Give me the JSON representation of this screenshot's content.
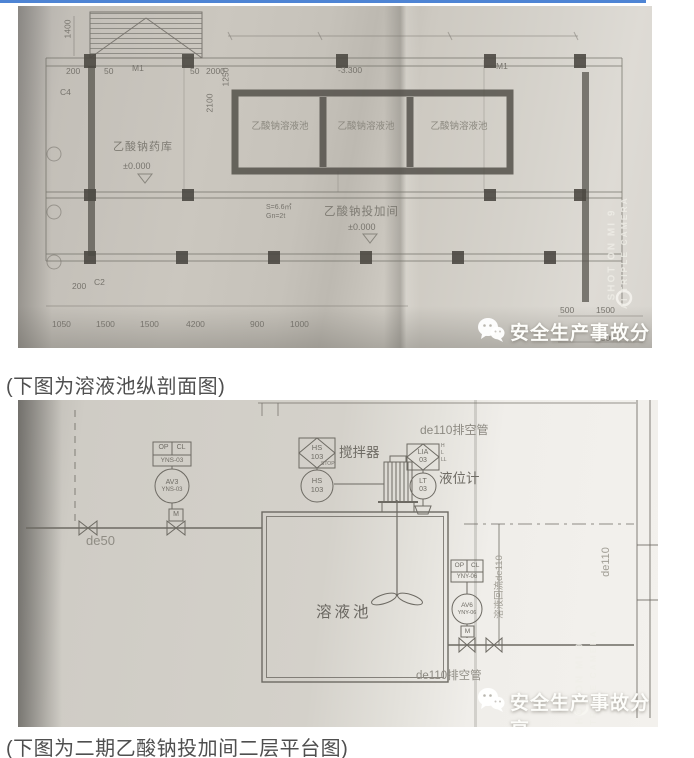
{
  "page": {
    "accent_blue": "#4e84d4",
    "caption1": "(下图为溶液池纵剖面图)",
    "caption2": "(下图为二期乙酸钠投加间二层平台图)"
  },
  "watermark": {
    "text": "安全生产事故分享",
    "camera1": "SHOT ON MI 9",
    "camera2": "AI TRIPLE CAMERA"
  },
  "plan": {
    "tanks": [
      "乙酸钠溶液池",
      "乙酸钠溶液池",
      "乙酸钠溶液池"
    ],
    "storage_room": "乙酸钠药库",
    "dosing_room": "乙酸钠投加间",
    "elev_zero": "±0.000",
    "elev_neg": "-3.300",
    "area": "S=6.6㎡",
    "load": "Gn=2t",
    "door": "M1",
    "win_c2": "C2",
    "win_c4": "C4",
    "dim_200": "200",
    "dim_50": "50",
    "dim_2000": "2000",
    "dim_1400": "1400",
    "dim_2100": "2100",
    "dim_1250": "1250",
    "dims_bottom": [
      "1050",
      "1500",
      "1500",
      "4200",
      "900",
      "1000"
    ],
    "dim_500": "500",
    "dim_1500r": "1500",
    "dim_4500": "4500"
  },
  "pid": {
    "vent_top": "de110排空管",
    "vent_bottom": "de110排空管",
    "de50": "de50",
    "de110": "de110",
    "return_line": "溶液回流de110",
    "agitator": "搅拌器",
    "level_gauge": "液位计",
    "tank": "溶液池",
    "hs1": "HS",
    "hs2": "103",
    "stop": "STOP",
    "lia1": "LIA",
    "lia2": "03",
    "mark_h": "H",
    "mark_l": "L",
    "mark_ll": "LL",
    "lt1": "LT",
    "lt2": "03",
    "op": "OP",
    "cl": "CL",
    "av3": "AV3",
    "yns": "YNS-03",
    "av6": "AV6",
    "yny": "YNY-06",
    "m": "M"
  }
}
